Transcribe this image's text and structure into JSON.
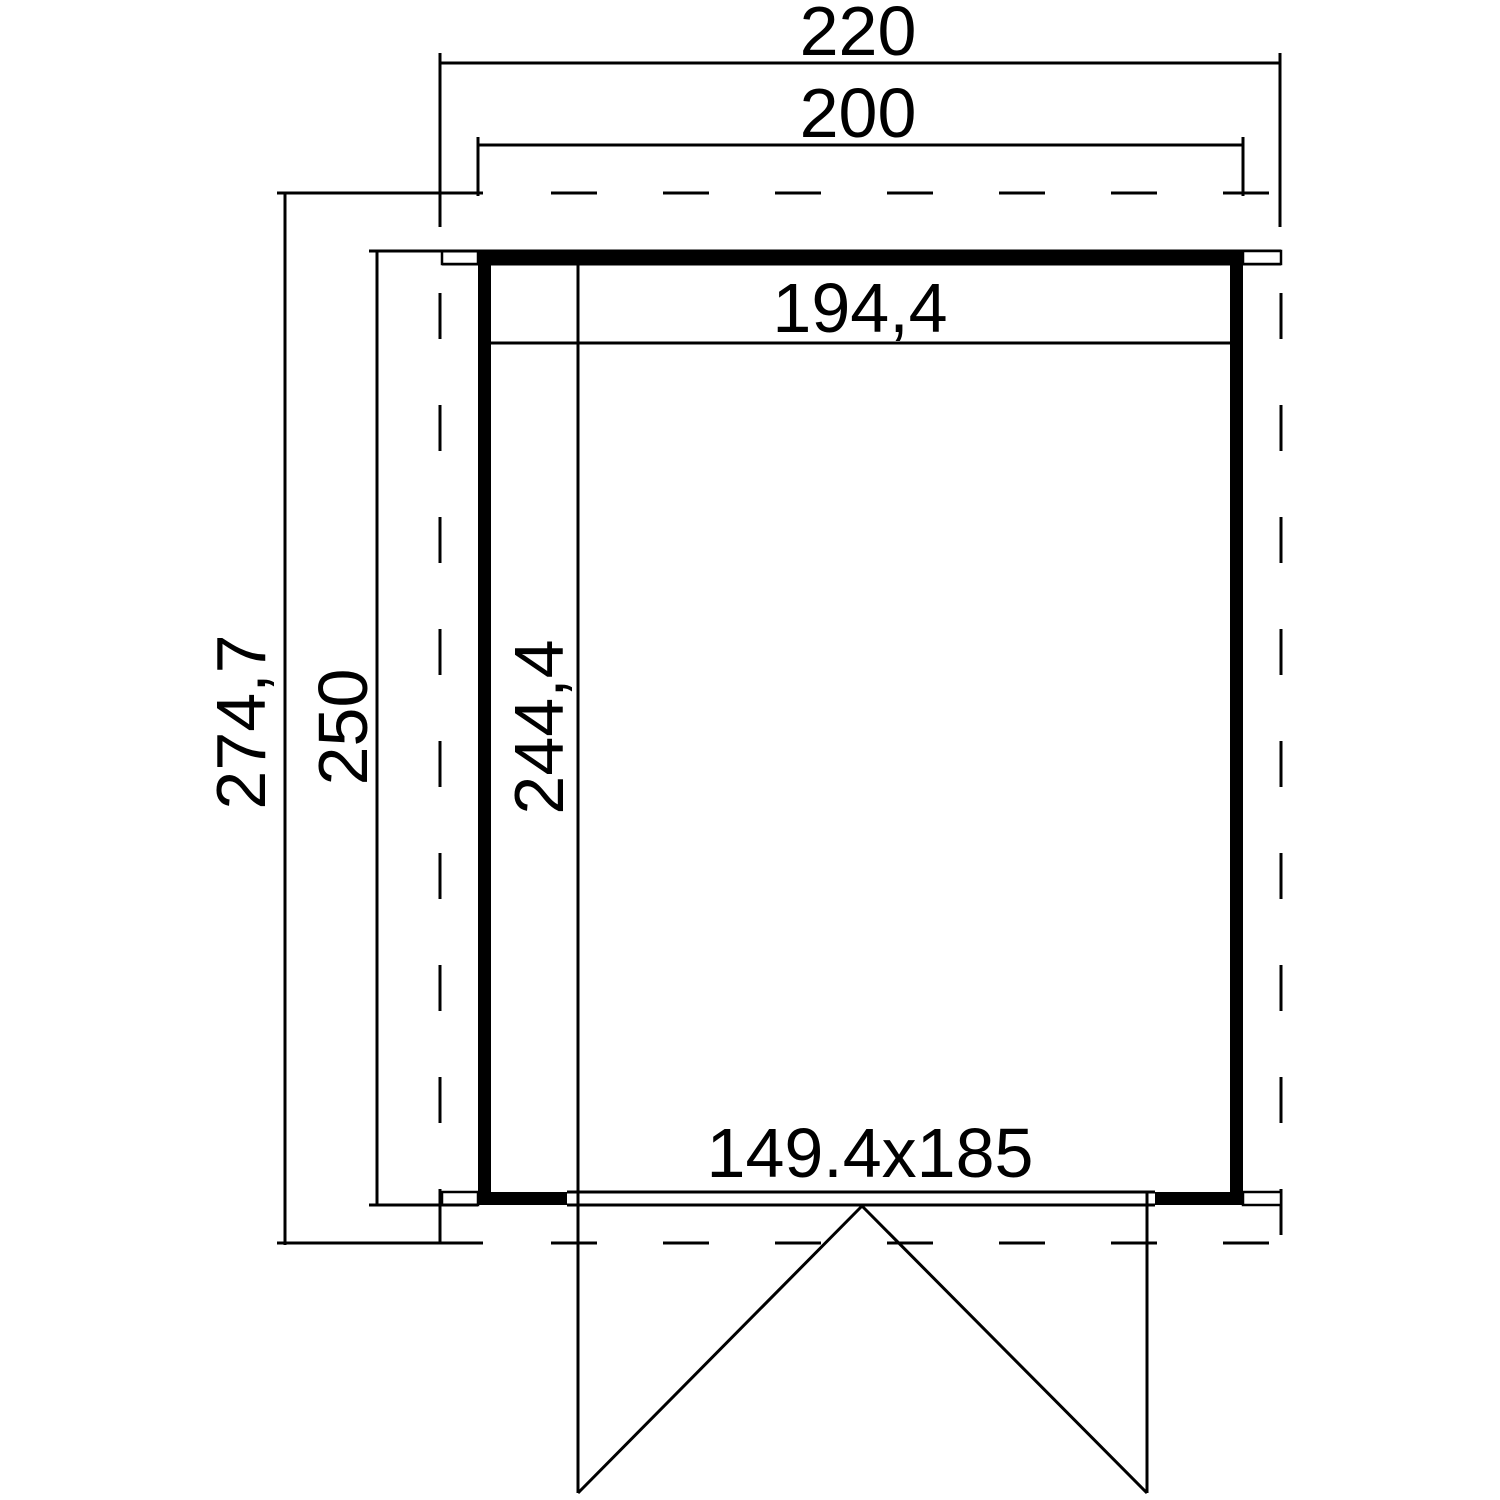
{
  "page": {
    "background": "#ffffff",
    "line_color": "#000000"
  },
  "floor_plan": {
    "type": "shed-floor-plan",
    "labels": {
      "overall_width": "220",
      "base_width": "200",
      "interior_width": "194,4",
      "overall_depth": "274,7",
      "base_depth": "250",
      "interior_depth": "244,4",
      "door_dimensions": "149.4x185"
    }
  }
}
